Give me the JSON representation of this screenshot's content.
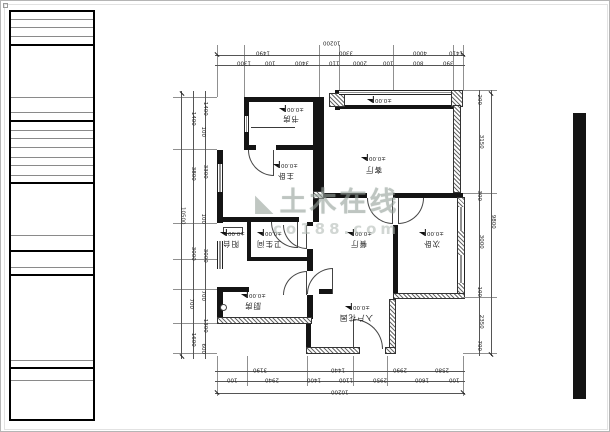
{
  "watermark": {
    "brand": "土木在线",
    "site": "co188.com",
    "logo": "triangle-icon",
    "color": "#97a39c"
  },
  "rooms": [
    {
      "label": "书房",
      "elevation": "±0.00"
    },
    {
      "label": "主卧",
      "elevation": "±0.00"
    },
    {
      "label": "客厅",
      "elevation": "±0.00"
    },
    {
      "label": "餐厅",
      "elevation": "±0.00"
    },
    {
      "label": "次卧",
      "elevation": "±0.00"
    },
    {
      "label": "卫生间",
      "elevation": "±0.00"
    },
    {
      "label": "厨房",
      "elevation": "±0.00"
    },
    {
      "label": "阳台",
      "elevation": "±0.00"
    },
    {
      "label": "入户花园",
      "elevation": "±0.00"
    },
    {
      "label": "",
      "elevation": "±0.00"
    }
  ],
  "dims": {
    "top": {
      "overall": "10200",
      "row1": [
        "1490",
        "3300",
        "4000",
        "1410"
      ],
      "row2": [
        "1300",
        "100",
        "3400",
        "110",
        "2000",
        "100",
        "800",
        "390"
      ]
    },
    "bottom": {
      "overall": "10200",
      "row1": [
        "3190",
        "1440",
        "2990",
        "2580"
      ],
      "row2": [
        "100",
        "2940",
        "1400",
        "1100",
        "2950",
        "1600",
        "100"
      ]
    },
    "left": {
      "overall": "10500",
      "row1": [
        "1400",
        "3800",
        "3000",
        "700",
        "1600"
      ],
      "row2": [
        "1400",
        "100",
        "3300",
        "100",
        "3000",
        "700",
        "1300",
        "600"
      ]
    },
    "right": {
      "overall": "9800",
      "row1": [
        "200",
        "3150",
        "300",
        "3000",
        "100",
        "2350",
        "700"
      ]
    }
  }
}
